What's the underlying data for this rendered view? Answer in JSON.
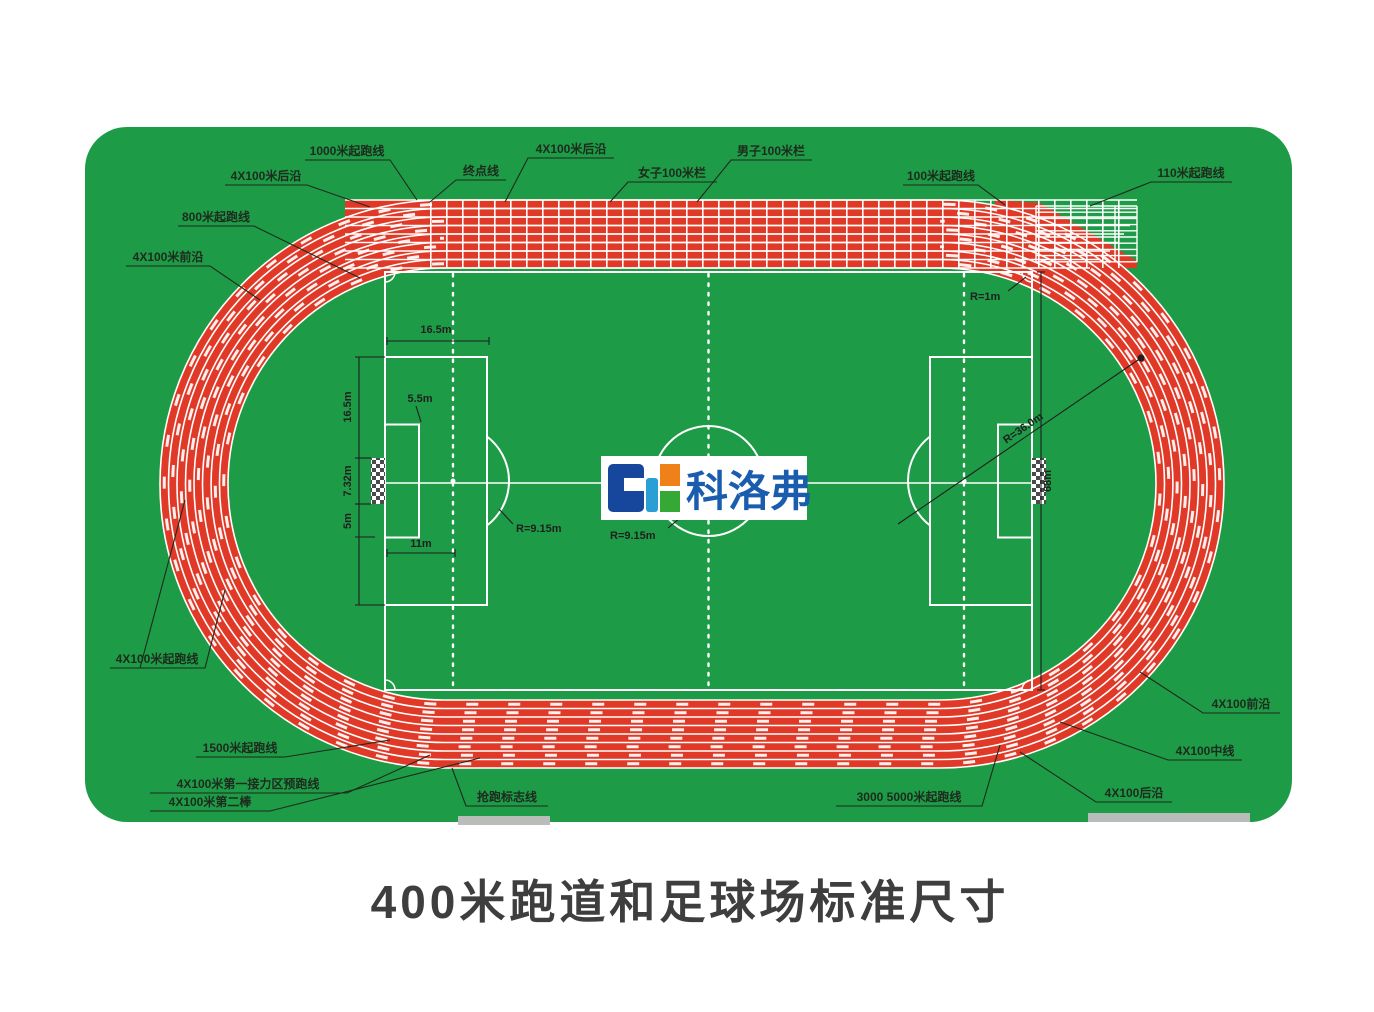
{
  "title": "400米跑道和足球场标准尺寸",
  "logo": {
    "brand_text": "科洛弗"
  },
  "colors": {
    "green": "#1e9b47",
    "red": "#e13927",
    "white": "#ffffff",
    "label": "#1d2a1d",
    "dim": "#1f1f1f",
    "title": "#3e3e3e",
    "logo-blue": "#1a5cad",
    "logo-navy": "#16479d",
    "logo-cyan": "#2a9fd6",
    "logo-orange": "#f08118",
    "logo-green": "#35a836",
    "graybar": "#b9bdb9"
  },
  "track_labels": {
    "start_1000m": "1000米起跑线",
    "relay_rear_left": "4X100米后沿",
    "start_800m": "800米起跑线",
    "relay_front_left": "4X100米前沿",
    "finish_line": "终点线",
    "relay_rear_top": "4X100米后沿",
    "women_100m_hurdles": "女子100米栏",
    "men_100m_hurdles": "男子100米栏",
    "start_100m": "100米起跑线",
    "start_110m": "110米起跑线",
    "relay_start_left": "4X100米起跑线",
    "start_1500m": "1500米起跑线",
    "relay_first_zone": "4X100米第一接力区预跑线",
    "relay_second_leg": "4X100米第二棒",
    "break_mark_line": "抢跑标志线",
    "start_3000_5000": "3000 5000米起跑线",
    "relay_front_right": "4X100前沿",
    "relay_mid_right": "4X100中线",
    "relay_rear_right": "4X100后沿"
  },
  "field_dims": {
    "penalty_depth": "16.5m",
    "goal_area_depth": "5.5m",
    "penalty_side": "16.5m",
    "goal_width": "7.32m",
    "goal_margin": "5m",
    "penalty_spot": "11m",
    "penalty_arc": "R=9.15m",
    "center_circle": "R=9.15m",
    "corner_arc": "R=1m",
    "curve_radius": "R=36.0m",
    "field_width": "68m"
  }
}
